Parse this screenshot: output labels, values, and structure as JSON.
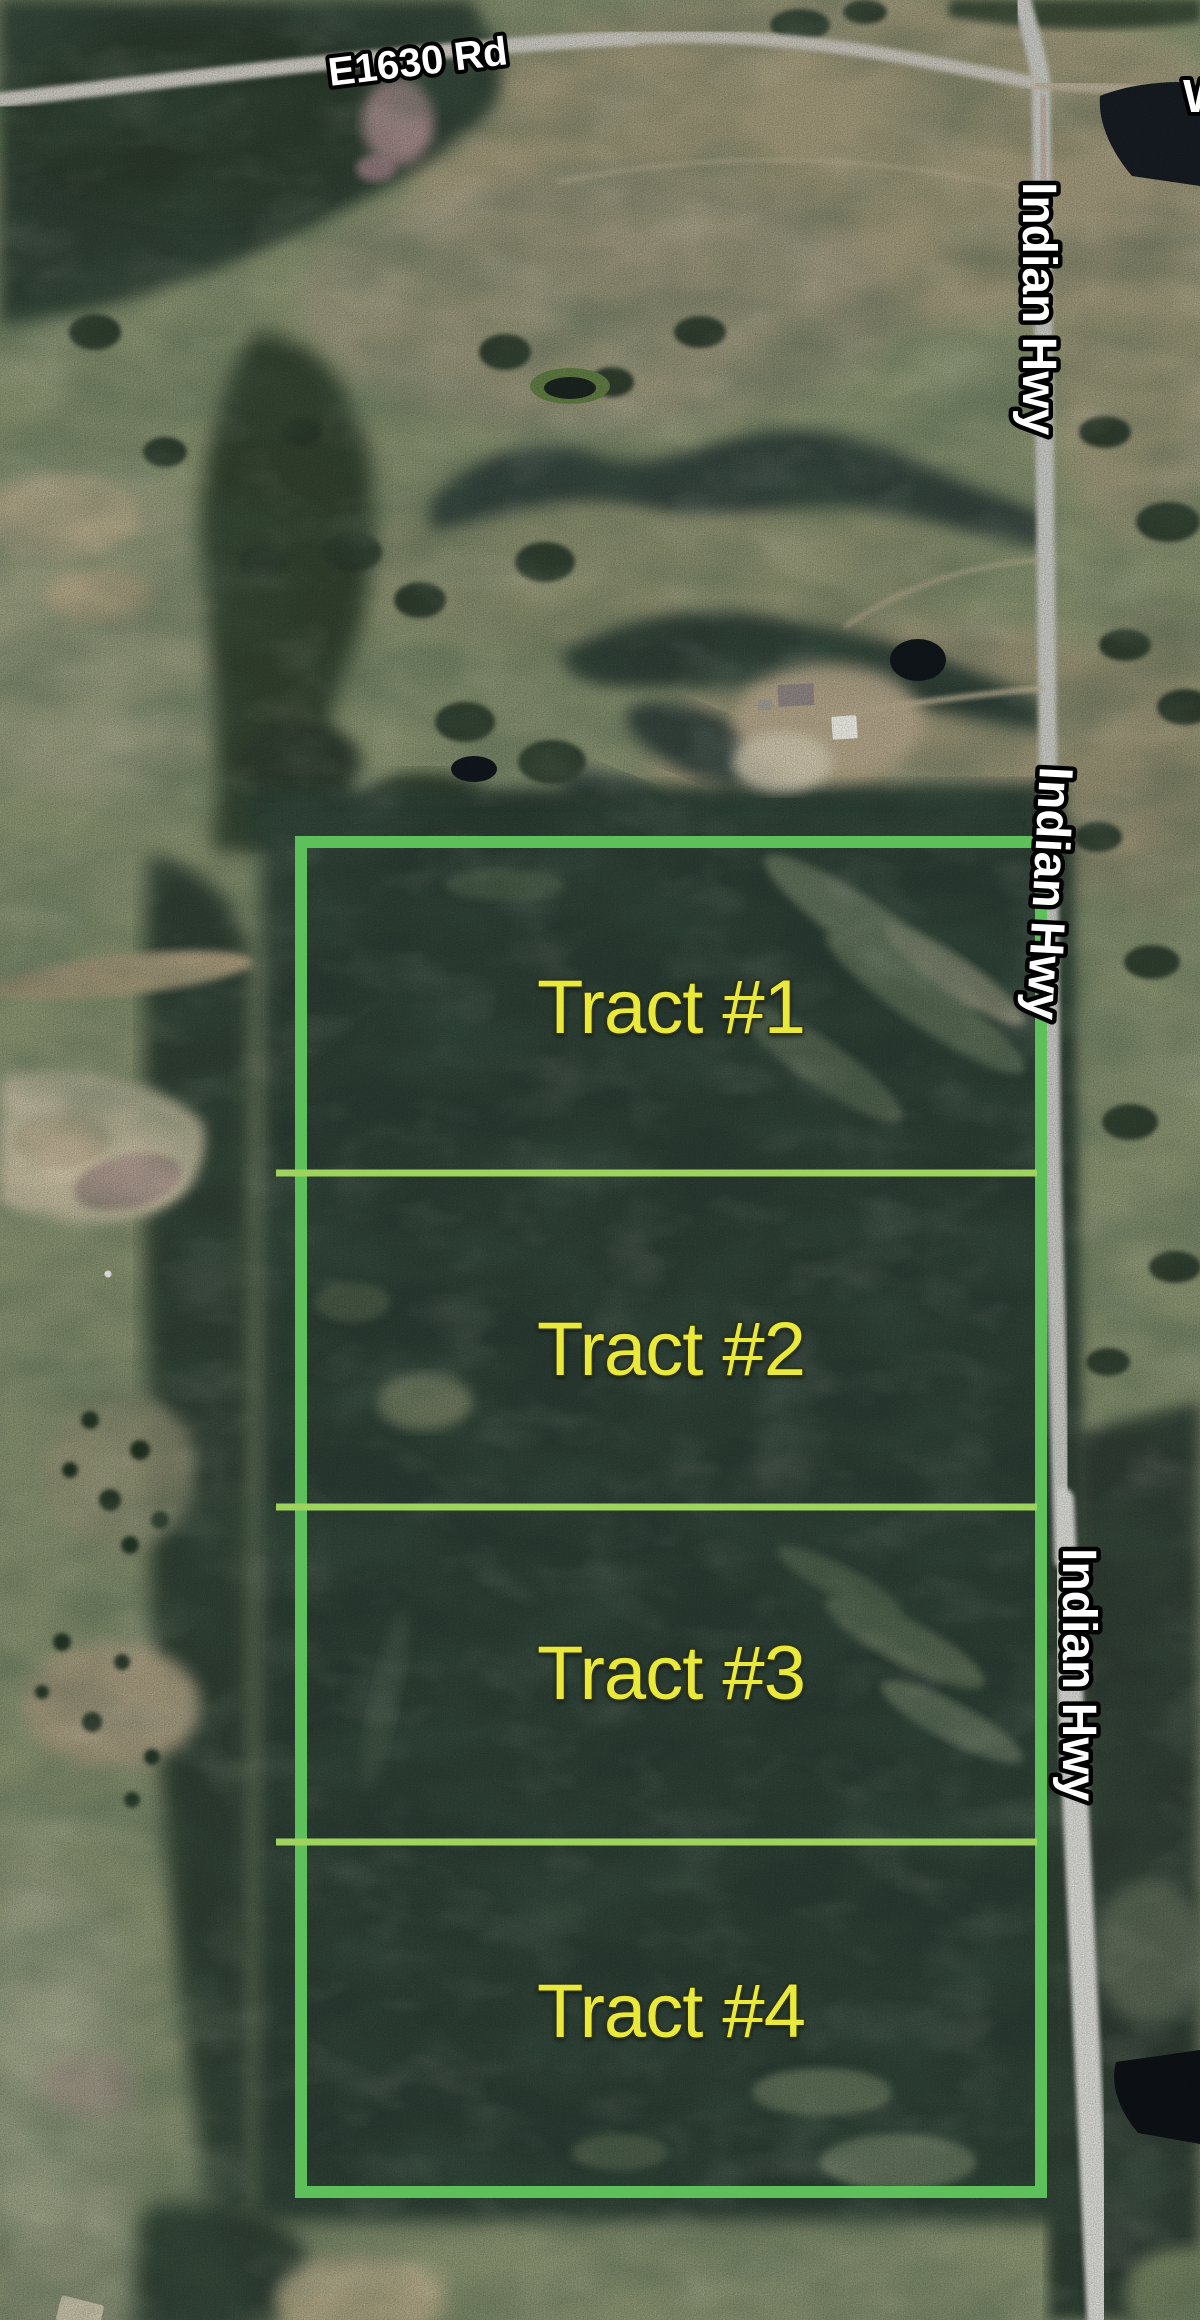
{
  "map": {
    "description": "Aerial plat map of rural acreage divided into four tracts beside Indian Hwy",
    "roads": {
      "e1630_label": "E1630 Rd",
      "indian_hwy_labels": [
        "Indian Hwy",
        "Indian Hwy",
        "Indian Hwy"
      ],
      "edge_partial_label": "W"
    },
    "tracts": [
      {
        "label": "Tract #1"
      },
      {
        "label": "Tract #2"
      },
      {
        "label": "Tract #3"
      },
      {
        "label": "Tract #4"
      }
    ],
    "colors": {
      "tract_outline": "#5ec05b",
      "tract_divider": "#9ed45d",
      "tract_label_fill": "#e9e93e",
      "road_label_fill": "#ffffff",
      "road_label_outline": "#000000"
    }
  }
}
